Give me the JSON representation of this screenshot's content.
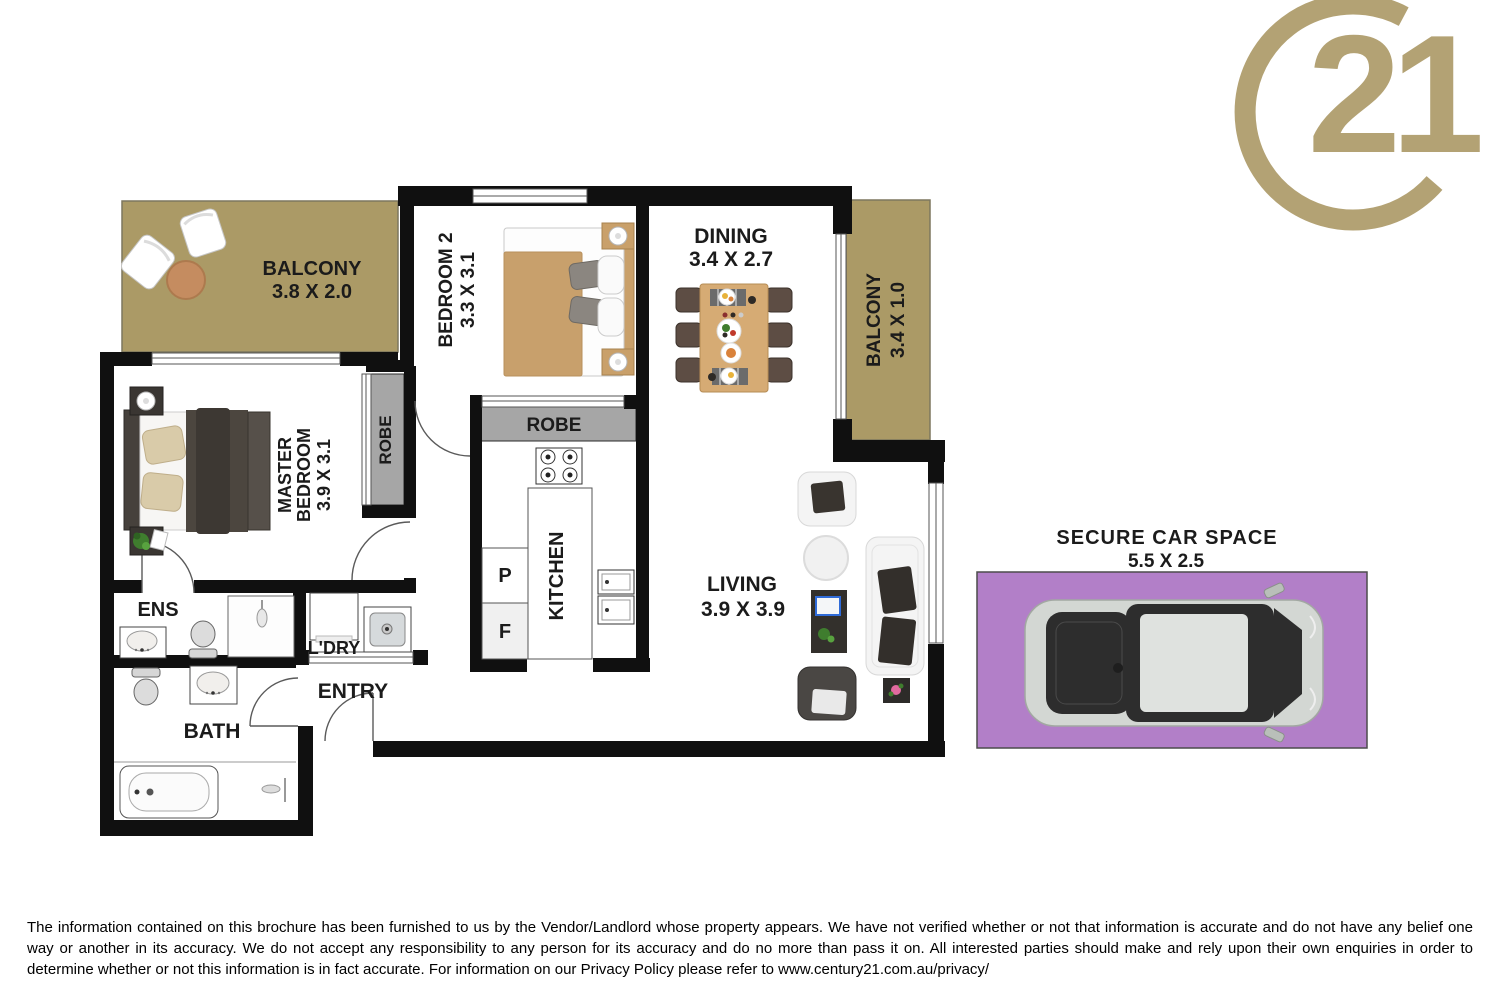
{
  "logo": {
    "number": "21",
    "gold": "#b3a274"
  },
  "rooms": {
    "balcony_top": {
      "name": "BALCONY",
      "dims": "3.8 X 2.0"
    },
    "bedroom2": {
      "name": "BEDROOM 2",
      "dims": "3.3 X 3.1"
    },
    "dining": {
      "name": "DINING",
      "dims": "3.4 X 2.7"
    },
    "balcony_right": {
      "name": "BALCONY",
      "dims": "3.4 X 1.0"
    },
    "master_bedroom": {
      "line1": "MASTER",
      "line2": "BEDROOM",
      "dims": "3.9 X 3.1"
    },
    "robe_master": {
      "name": "ROBE"
    },
    "robe_bedroom2": {
      "name": "ROBE"
    },
    "kitchen": {
      "name": "KITCHEN",
      "pantry": "P",
      "fridge": "F"
    },
    "living": {
      "name": "LIVING",
      "dims": "3.9 X 3.9"
    },
    "ens": {
      "name": "ENS"
    },
    "laundry": {
      "name": "L'DRY"
    },
    "entry": {
      "name": "ENTRY"
    },
    "bath": {
      "name": "BATH"
    }
  },
  "car_space": {
    "title": "SECURE CAR SPACE",
    "dims": "5.5 X 2.5",
    "fill": "#b27fc8"
  },
  "disclaimer": "The information contained on this brochure has been furnished to us by the Vendor/Landlord whose property appears. We have not verified whether or not that information is accurate and do not have any belief one way or another in its accuracy. We do not accept any responsibility to any person for its accuracy and do no more than pass it on. All interested parties should make and rely upon their own enquiries in order to determine whether or not this information is in fact accurate. For information on our Privacy Policy please refer to www.century21.com.au/privacy/"
}
